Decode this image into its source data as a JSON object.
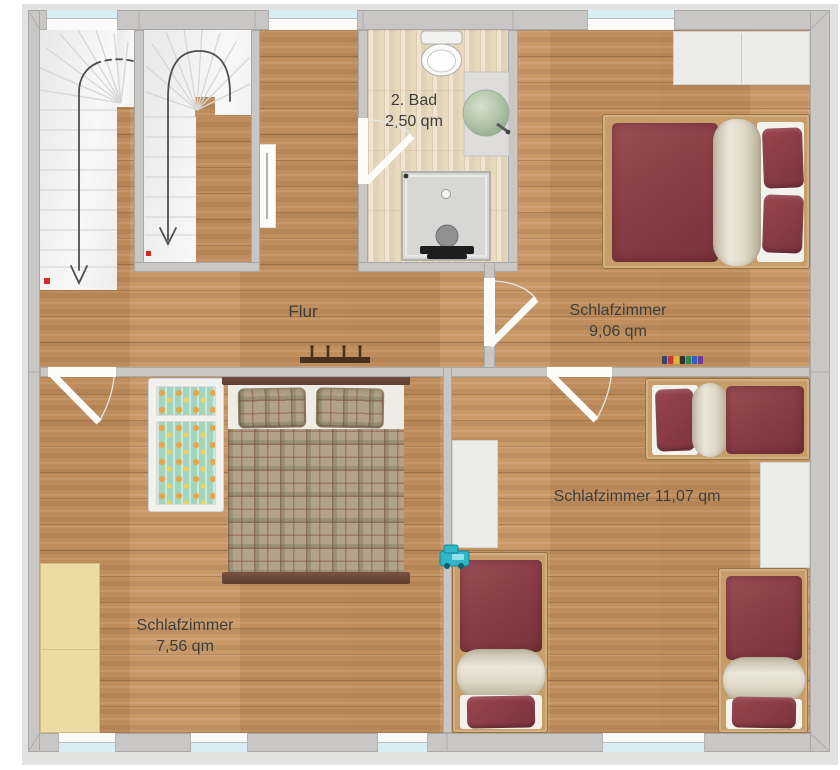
{
  "labels": {
    "bad_name": "2. Bad",
    "bad_area": "2,50 qm",
    "flur": "Flur",
    "sz9_name": "Schlafzimmer",
    "sz9_area": "9,06 qm",
    "sz11": "Schlafzimmer 11,07 qm",
    "sz7_name": "Schlafzimmer",
    "sz7_area": "7,56 qm"
  },
  "rooms": [
    {
      "name": "2. Bad",
      "area": "2,50 qm"
    },
    {
      "name": "Flur",
      "area": ""
    },
    {
      "name": "Schlafzimmer",
      "area": "9,06 qm"
    },
    {
      "name": "Schlafzimmer",
      "area": "11,07 qm"
    },
    {
      "name": "Schlafzimmer",
      "area": "7,56 qm"
    }
  ],
  "icons": {
    "stair_direction": "curved-down-arrow",
    "door_swing": "quarter-arc-leaf"
  },
  "colors": {
    "wall": "#c8c7c5",
    "wall_outer_face": "#e2e2e0",
    "floor_oak": "#c6935f",
    "floor_bath": "#e8dabd",
    "window_glass": "#d9edf5",
    "bed_red": "#8c3e47",
    "duvet_cream": "#e6e0d3",
    "plaid_tan": "#b1a289",
    "bed_frame_wood": "#c79d6a",
    "dark_bed_wood": "#6a4636",
    "wardrobe_beige": "#ecdca4",
    "wardrobe_white": "#ececea",
    "sink_sage": "#b2c4aa",
    "toy_teal": "#2fb6c8",
    "stair_marker_red": "#d42a2a",
    "label_text": "#3e3e3e"
  }
}
